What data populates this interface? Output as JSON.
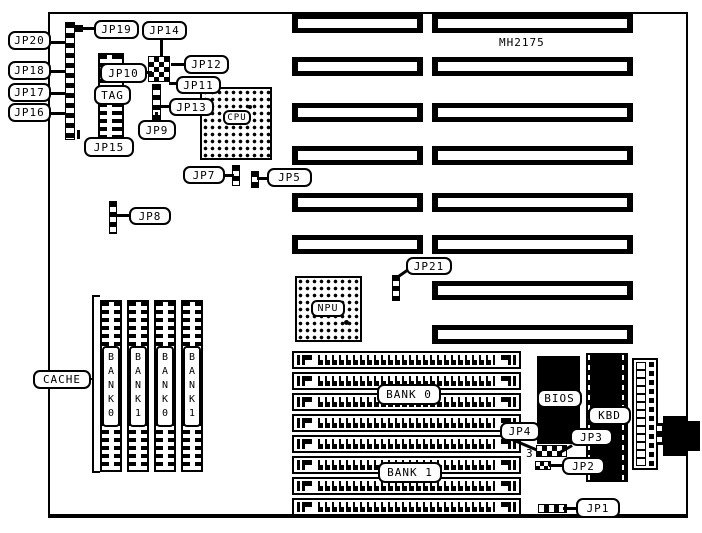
{
  "board": {
    "model": "MH2175"
  },
  "callouts": {
    "jp1": "JP1",
    "jp2": "JP2",
    "jp3": "JP3",
    "jp4": "JP4",
    "jp5": "JP5",
    "jp7": "JP7",
    "jp8": "JP8",
    "jp9": "JP9",
    "jp10": "JP10",
    "jp11": "JP11",
    "jp12": "JP12",
    "jp13": "JP13",
    "jp14": "JP14",
    "jp15": "JP15",
    "jp16": "JP16",
    "jp17": "JP17",
    "jp18": "JP18",
    "jp19": "JP19",
    "jp20": "JP20",
    "jp21": "JP21",
    "tag": "TAG",
    "cache": "CACHE",
    "bios": "BIOS",
    "kbd": "KBD",
    "cpu": "CPU",
    "npu": "NPU",
    "simm_bank0": "BANK 0",
    "simm_bank1": "BANK 1",
    "pin3": "3"
  },
  "cache_banks": [
    {
      "label": "BANK0"
    },
    {
      "label": "BANK1"
    },
    {
      "label": "BANK0"
    },
    {
      "label": "BANK1"
    }
  ]
}
